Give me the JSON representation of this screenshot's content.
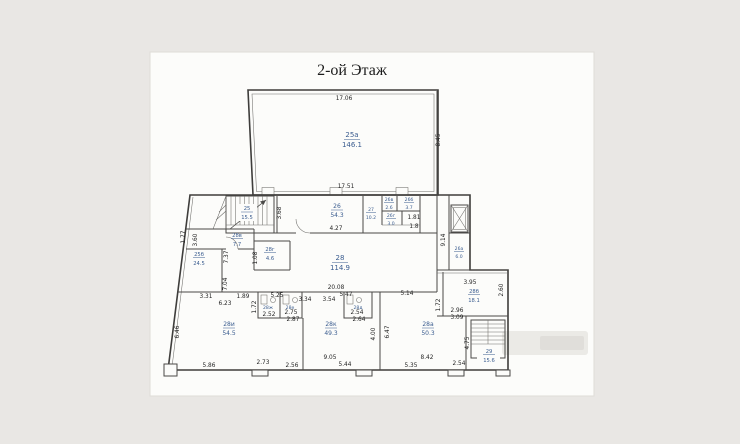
{
  "title": "2-ой Этаж",
  "colors": {
    "room_label": "#3a5c8f",
    "dimension_text": "#242424",
    "wall": "#3e3d3b",
    "paper": "#fcfcfa",
    "page_background": "#e9e7e4"
  },
  "rooms": {
    "hall": {
      "num": "25а",
      "area": "146.1"
    },
    "stair_upper": {
      "num": "25",
      "area": "15.5"
    },
    "r25b": {
      "num": "25б",
      "area": "24.5"
    },
    "r26": {
      "num": "26",
      "area": "54.3"
    },
    "r26a": {
      "num": "26а",
      "area": "6.0"
    },
    "r26b": {
      "num": "26б",
      "area": "3.7"
    },
    "r26v": {
      "num": "26в",
      "area": "2.6"
    },
    "r26g": {
      "num": "26г",
      "area": "3.0"
    },
    "r27": {
      "num": "27",
      "area": "10.2"
    },
    "r28": {
      "num": "28",
      "area": "114.9"
    },
    "r28a": {
      "num": "28а",
      "area": "50.3"
    },
    "r28b": {
      "num": "28б",
      "area": "18.1"
    },
    "r28v": {
      "num": "28в",
      "area": "7.7"
    },
    "r28g": {
      "num": "28г",
      "area": "4.6"
    },
    "r28zh": {
      "num": "28ж"
    },
    "r28e": {
      "num": "28е"
    },
    "r28d": {
      "num": "28д"
    },
    "r28i": {
      "num": "28и",
      "area": "54.5"
    },
    "r28k": {
      "num": "28к",
      "area": "49.3"
    },
    "stair_lower": {
      "num": "29",
      "area": "15.6"
    }
  },
  "dims": {
    "hall_top": "17.06",
    "hall_right": "8.45",
    "hall_bottom": "17.51",
    "r26_left": "3.68",
    "r26_bottom": "4.27",
    "shaft_h": "9.14",
    "r28v_left": "3.60",
    "left_177": "1.77",
    "r25b_right_top": "7.37",
    "r25b_right_bottom": "7.04",
    "r28g_left": "1.08",
    "cluster_181": "1.81",
    "cluster_18": "1.8",
    "r28_bottom": "20.08",
    "b331": "3.31",
    "b189": "1.89",
    "b623": "6.23",
    "b525": "5.25",
    "b334": "3.34",
    "b354": "3.54",
    "b547": "5.47",
    "b514": "5.14",
    "r28b_top": "3.95",
    "r28b_right": "2.60",
    "v172a": "1.72",
    "b296": "2.96",
    "b309": "3.09",
    "v172b": "1.72",
    "wc252": "2.52",
    "wc275": "2.75",
    "wc287": "2.87",
    "wc254": "2.54",
    "wc264": "2.64",
    "left_646": "6.46",
    "v400": "4.00",
    "v647": "6.47",
    "stairs_475": "4.75",
    "bm586": "5.86",
    "bm273": "2.73",
    "bm256": "2.56",
    "bm905": "9.05",
    "bm544": "5.44",
    "bm842": "8.42",
    "bm535": "5.35",
    "bm254": "2.54"
  }
}
